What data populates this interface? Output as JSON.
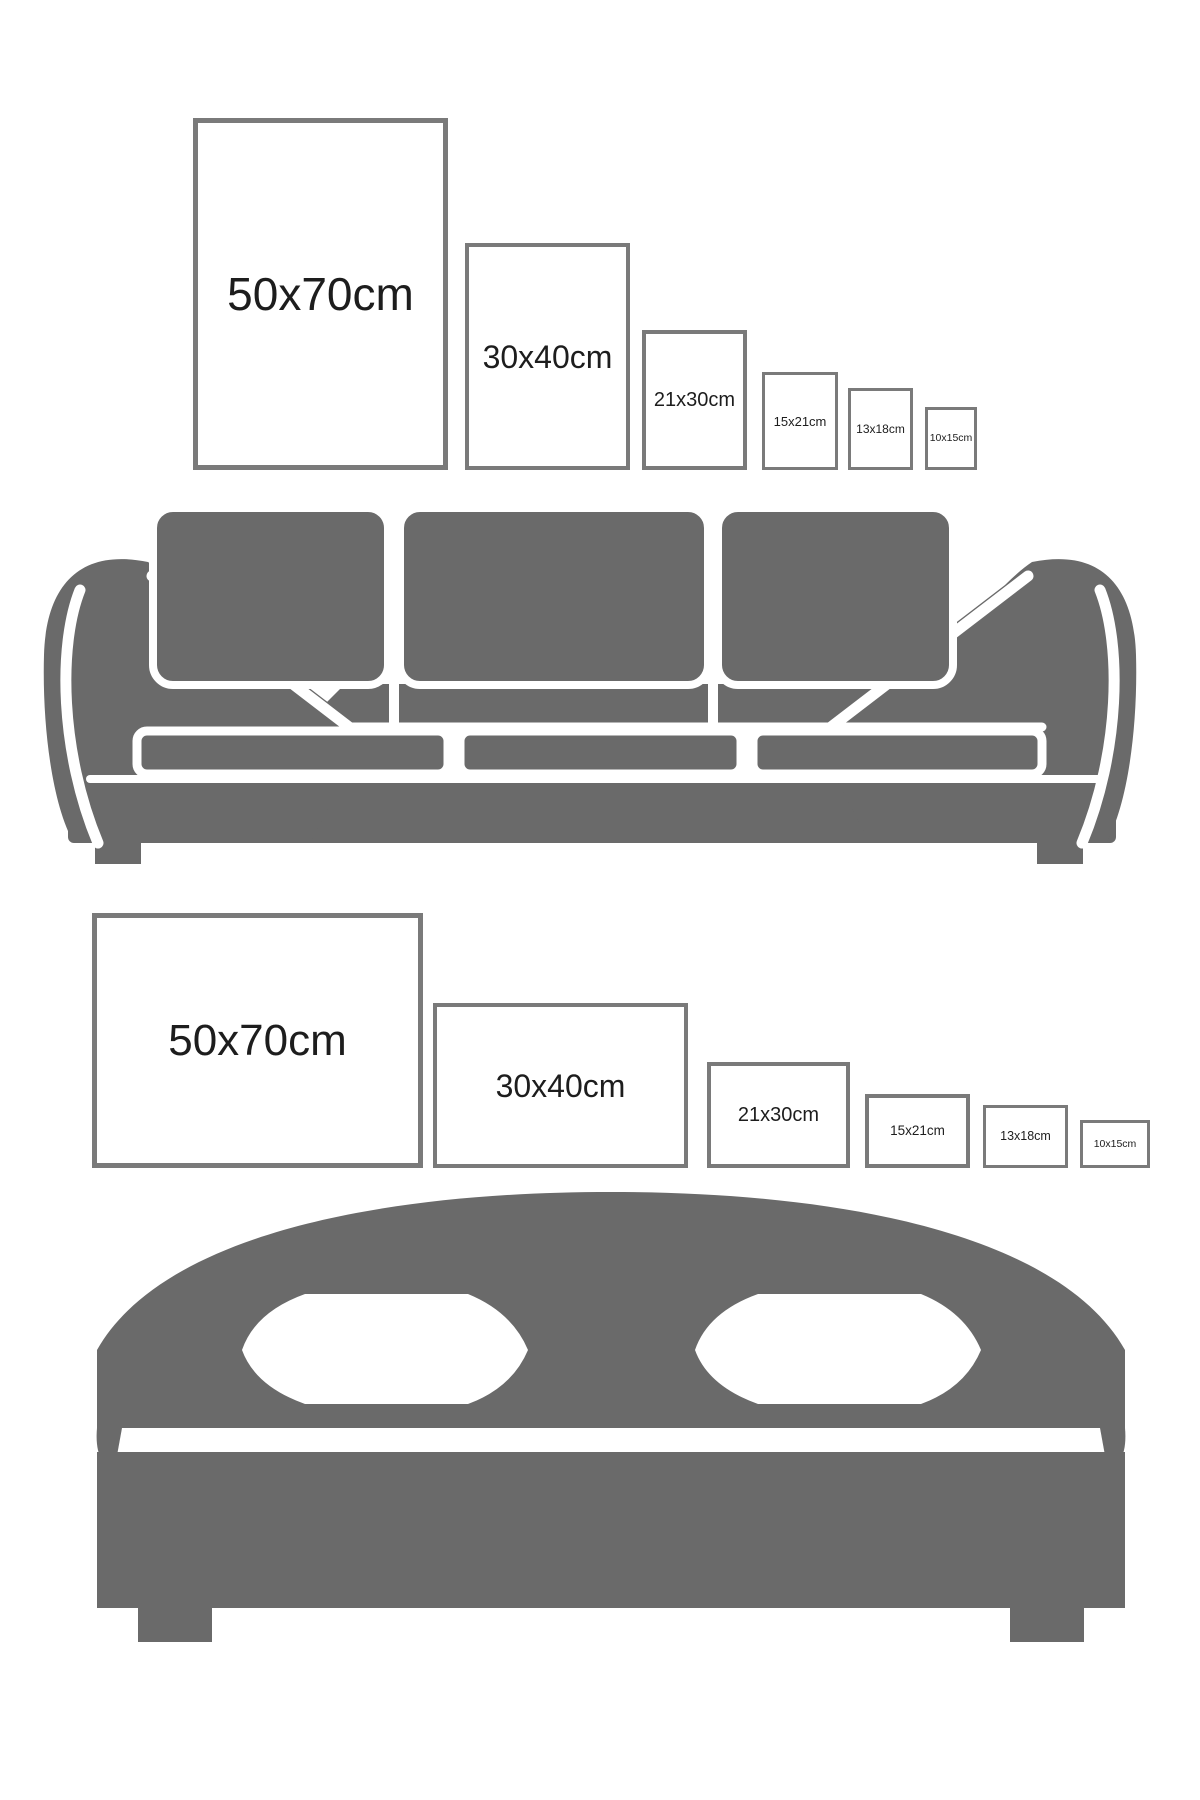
{
  "colors": {
    "furniture": "#6a6a6a",
    "frame_border": "#7a7a7a",
    "label_text": "#1d1d1d",
    "background": "#ffffff"
  },
  "portrait_row": {
    "description": "poster size comparison, portrait orientation, above sofa",
    "frames": [
      {
        "label": "50x70cm"
      },
      {
        "label": "30x40cm"
      },
      {
        "label": "21x30cm"
      },
      {
        "label": "15x21cm"
      },
      {
        "label": "13x18cm"
      },
      {
        "label": "10x15cm"
      }
    ]
  },
  "landscape_row": {
    "description": "poster size comparison, landscape orientation, above bed",
    "frames": [
      {
        "label": "50x70cm"
      },
      {
        "label": "30x40cm"
      },
      {
        "label": "21x30cm"
      },
      {
        "label": "15x21cm"
      },
      {
        "label": "13x18cm"
      },
      {
        "label": "10x15cm"
      }
    ]
  },
  "illustrations": {
    "sofa": "sofa-silhouette",
    "bed": "bed-silhouette"
  }
}
